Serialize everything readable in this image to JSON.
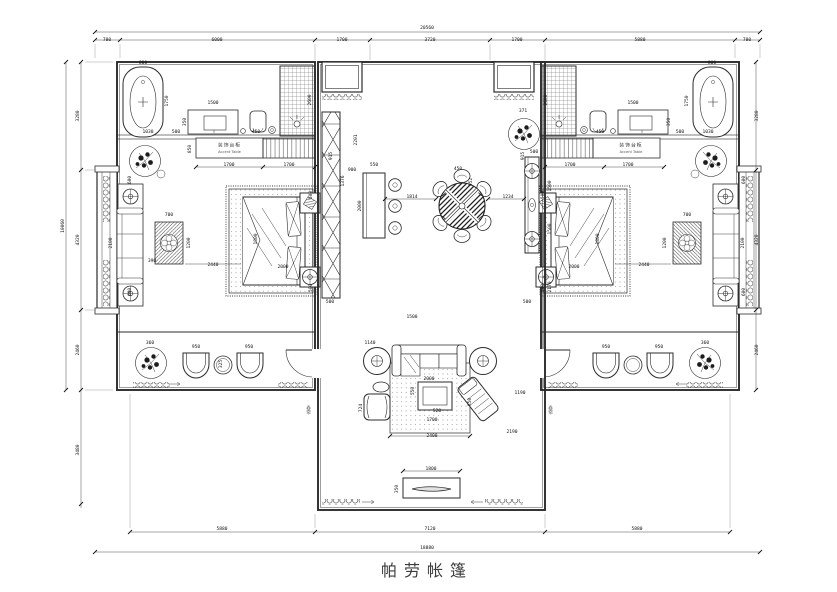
{
  "title": "帕劳帐篷",
  "labels": {
    "accent_table_cn": "装饰台柜",
    "accent_table_en": "Accent Table",
    "door_screen": "卷帘"
  },
  "dimensions_summary": {
    "top_segments": [
      "780",
      "6000",
      "1700",
      "3720",
      "1700",
      "5880",
      "780"
    ],
    "top_overall": "20560",
    "bottom_segments": [
      "5880",
      "7120",
      "5880"
    ],
    "bottom_overall": "18880",
    "left_segments": [
      "3280",
      "4320",
      "2460"
    ],
    "left_overall": "10060",
    "left_lower": "3480",
    "right_segments": [
      "3280",
      "4320",
      "2460"
    ]
  },
  "dim_labels": [
    {
      "x": 107,
      "y": 41,
      "t": "780"
    },
    {
      "x": 217,
      "y": 41,
      "t": "6000"
    },
    {
      "x": 342,
      "y": 41,
      "t": "1700"
    },
    {
      "x": 430,
      "y": 41,
      "t": "3720"
    },
    {
      "x": 517,
      "y": 41,
      "t": "1700"
    },
    {
      "x": 640,
      "y": 41,
      "t": "5880"
    },
    {
      "x": 747,
      "y": 41,
      "t": "780"
    },
    {
      "x": 427,
      "y": 29,
      "t": "20560"
    },
    {
      "x": 222,
      "y": 530,
      "t": "5880"
    },
    {
      "x": 430,
      "y": 530,
      "t": "7120"
    },
    {
      "x": 637,
      "y": 530,
      "t": "5880"
    },
    {
      "x": 427,
      "y": 549,
      "t": "18880"
    },
    {
      "x": 79,
      "y": 116,
      "t": "3280",
      "v": 1
    },
    {
      "x": 79,
      "y": 240,
      "t": "4320",
      "v": 1
    },
    {
      "x": 79,
      "y": 350,
      "t": "2460",
      "v": 1
    },
    {
      "x": 64,
      "y": 226,
      "t": "10060",
      "v": 1
    },
    {
      "x": 79,
      "y": 450,
      "t": "3480",
      "v": 1
    },
    {
      "x": 758,
      "y": 116,
      "t": "3280",
      "v": 1
    },
    {
      "x": 758,
      "y": 240,
      "t": "4320",
      "v": 1
    },
    {
      "x": 758,
      "y": 350,
      "t": "2460",
      "v": 1
    },
    {
      "x": 143,
      "y": 64,
      "t": "800"
    },
    {
      "x": 168,
      "y": 101,
      "t": "1750",
      "v": 1
    },
    {
      "x": 213,
      "y": 104,
      "t": "1500"
    },
    {
      "x": 186,
      "y": 122,
      "t": "350",
      "v": 1
    },
    {
      "x": 148,
      "y": 133,
      "t": "1030"
    },
    {
      "x": 176,
      "y": 133,
      "t": "500"
    },
    {
      "x": 256,
      "y": 133,
      "t": "450"
    },
    {
      "x": 311,
      "y": 100,
      "t": "2600",
      "v": 1
    },
    {
      "x": 191,
      "y": 149,
      "t": "850",
      "v": 1
    },
    {
      "x": 229,
      "y": 166,
      "t": "1700"
    },
    {
      "x": 289,
      "y": 166,
      "t": "1700"
    },
    {
      "x": 332,
      "y": 156,
      "t": "915",
      "v": 1
    },
    {
      "x": 344,
      "y": 181,
      "t": "1376",
      "v": 1
    },
    {
      "x": 131,
      "y": 180,
      "t": "600",
      "v": 1
    },
    {
      "x": 112,
      "y": 243,
      "t": "2100",
      "v": 1
    },
    {
      "x": 131,
      "y": 292,
      "t": "600",
      "v": 1
    },
    {
      "x": 169,
      "y": 216,
      "t": "700"
    },
    {
      "x": 190,
      "y": 243,
      "t": "1200",
      "v": 1
    },
    {
      "x": 152,
      "y": 262,
      "t": "390"
    },
    {
      "x": 213,
      "y": 266,
      "t": "2440"
    },
    {
      "x": 257,
      "y": 239,
      "t": "1800",
      "v": 1
    },
    {
      "x": 283,
      "y": 268,
      "t": "2000"
    },
    {
      "x": 312,
      "y": 195,
      "t": "500",
      "v": 1
    },
    {
      "x": 312,
      "y": 288,
      "t": "500",
      "v": 1
    },
    {
      "x": 330,
      "y": 303,
      "t": "500"
    },
    {
      "x": 357,
      "y": 140,
      "t": "2201",
      "v": 1
    },
    {
      "x": 352,
      "y": 171,
      "t": "900"
    },
    {
      "x": 374,
      "y": 166,
      "t": "550"
    },
    {
      "x": 361,
      "y": 206,
      "t": "2000",
      "v": 1
    },
    {
      "x": 412,
      "y": 198,
      "t": "1814"
    },
    {
      "x": 458,
      "y": 170,
      "t": "450"
    },
    {
      "x": 472,
      "y": 182,
      "t": "952",
      "v": 1
    },
    {
      "x": 508,
      "y": 198,
      "t": "1234"
    },
    {
      "x": 551,
      "y": 186,
      "t": "1500",
      "v": 1
    },
    {
      "x": 551,
      "y": 229,
      "t": "1500",
      "v": 1
    },
    {
      "x": 534,
      "y": 153,
      "t": "500"
    },
    {
      "x": 523,
      "y": 112,
      "t": "371"
    },
    {
      "x": 551,
      "y": 287,
      "t": "2170",
      "v": 1
    },
    {
      "x": 412,
      "y": 318,
      "t": "1500"
    },
    {
      "x": 370,
      "y": 344,
      "t": "1140"
    },
    {
      "x": 429,
      "y": 380,
      "t": "2000"
    },
    {
      "x": 414,
      "y": 391,
      "t": "550",
      "v": 1
    },
    {
      "x": 437,
      "y": 412,
      "t": "520"
    },
    {
      "x": 432,
      "y": 421,
      "t": "1700"
    },
    {
      "x": 362,
      "y": 408,
      "t": "724",
      "v": 1
    },
    {
      "x": 520,
      "y": 394,
      "t": "1190"
    },
    {
      "x": 512,
      "y": 433,
      "t": "2190"
    },
    {
      "x": 432,
      "y": 437,
      "t": "2400"
    },
    {
      "x": 431,
      "y": 470,
      "t": "1800"
    },
    {
      "x": 398,
      "y": 489,
      "t": "350",
      "v": 1
    },
    {
      "x": 471,
      "y": 402,
      "t": "850",
      "v": 1
    },
    {
      "x": 150,
      "y": 344,
      "t": "360"
    },
    {
      "x": 196,
      "y": 348,
      "t": "950"
    },
    {
      "x": 249,
      "y": 348,
      "t": "950"
    },
    {
      "x": 222,
      "y": 364,
      "t": "325",
      "v": 1
    },
    {
      "x": 606,
      "y": 348,
      "t": "950"
    },
    {
      "x": 659,
      "y": 348,
      "t": "950"
    },
    {
      "x": 705,
      "y": 344,
      "t": "360"
    },
    {
      "x": 712,
      "y": 64,
      "t": "800"
    },
    {
      "x": 688,
      "y": 101,
      "t": "1750",
      "v": 1
    },
    {
      "x": 633,
      "y": 104,
      "t": "1500"
    },
    {
      "x": 547,
      "y": 100,
      "t": "2600",
      "v": 1
    },
    {
      "x": 670,
      "y": 122,
      "t": "350",
      "v": 1
    },
    {
      "x": 708,
      "y": 133,
      "t": "1030"
    },
    {
      "x": 680,
      "y": 133,
      "t": "500"
    },
    {
      "x": 600,
      "y": 133,
      "t": "450"
    },
    {
      "x": 570,
      "y": 166,
      "t": "1700"
    },
    {
      "x": 628,
      "y": 166,
      "t": "1700"
    },
    {
      "x": 524,
      "y": 156,
      "t": "915",
      "v": 1
    },
    {
      "x": 745,
      "y": 180,
      "t": "600",
      "v": 1
    },
    {
      "x": 744,
      "y": 243,
      "t": "2100",
      "v": 1
    },
    {
      "x": 745,
      "y": 292,
      "t": "600",
      "v": 1
    },
    {
      "x": 687,
      "y": 216,
      "t": "700"
    },
    {
      "x": 666,
      "y": 243,
      "t": "1200",
      "v": 1
    },
    {
      "x": 644,
      "y": 266,
      "t": "2440"
    },
    {
      "x": 599,
      "y": 239,
      "t": "1800",
      "v": 1
    },
    {
      "x": 574,
      "y": 268,
      "t": "2000"
    },
    {
      "x": 544,
      "y": 195,
      "t": "500",
      "v": 1
    },
    {
      "x": 544,
      "y": 288,
      "t": "500",
      "v": 1
    },
    {
      "x": 527,
      "y": 303,
      "t": "500"
    }
  ]
}
